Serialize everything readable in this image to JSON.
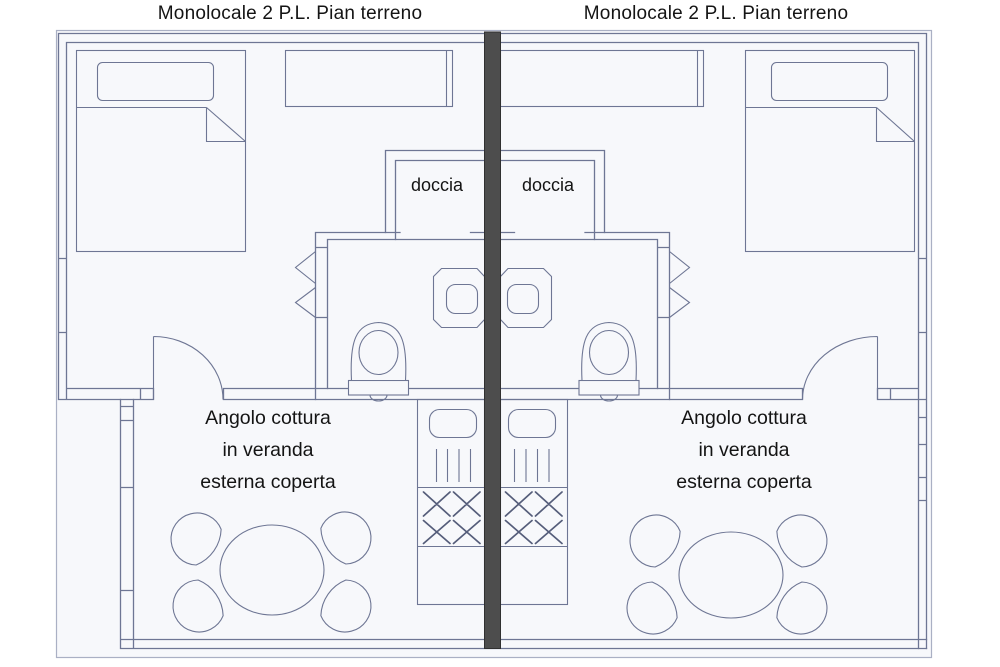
{
  "colors": {
    "page_bg": "#ffffff",
    "paper_color": "#f7f8fb",
    "line_color": "#6e7694",
    "accent_line": "#555d7a",
    "frame_color": "#aab0c4",
    "divider_color": "#4d4d4d",
    "divider_edge": "#303030",
    "text_color": "#141414"
  },
  "units": [
    {
      "side": "left",
      "title": "Monolocale 2 P.L. Pian terreno",
      "shower_label": "doccia",
      "veranda_label": [
        "Angolo cottura",
        "in veranda",
        "esterna coperta"
      ]
    },
    {
      "side": "right",
      "title": "Monolocale 2 P.L. Pian terreno",
      "shower_label": "doccia",
      "veranda_label": [
        "Angolo cottura",
        "in veranda",
        "esterna coperta"
      ]
    }
  ]
}
